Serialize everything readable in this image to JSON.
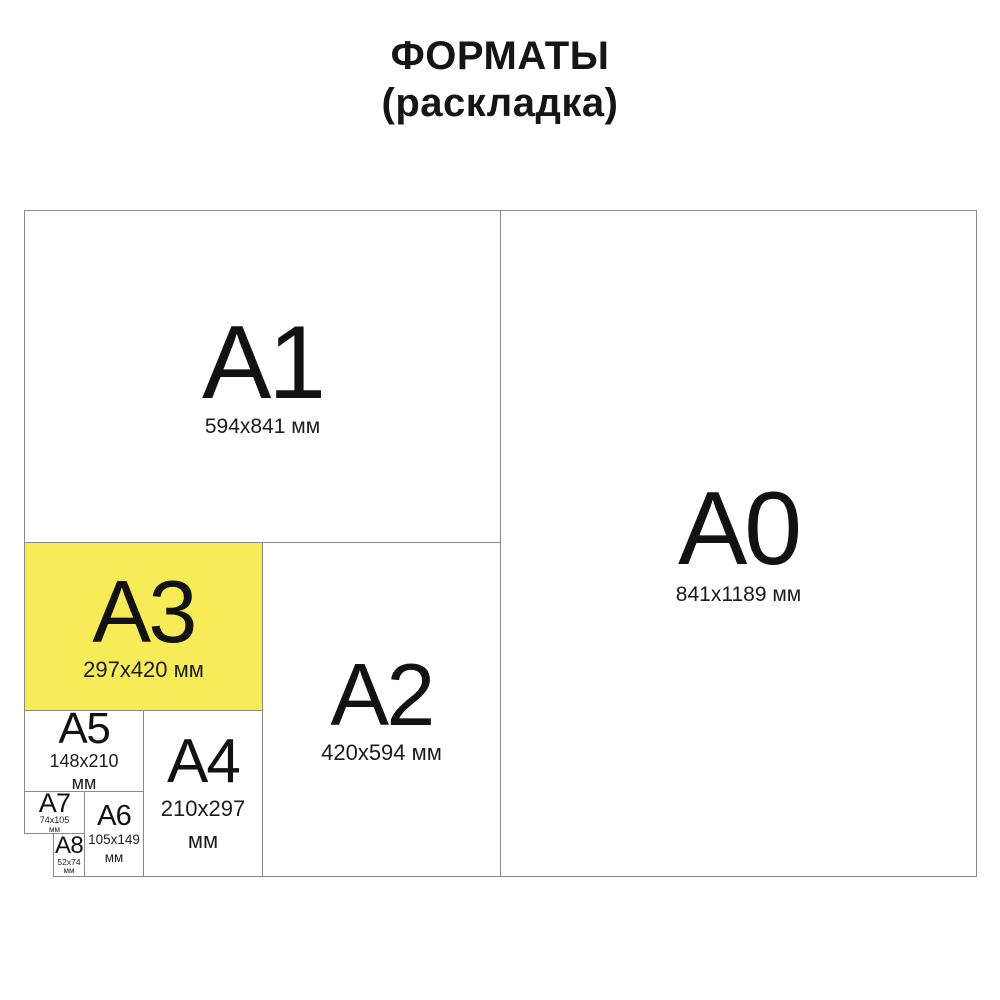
{
  "title": {
    "line1": "ФОРМАТЫ",
    "line2": "(раскладка)"
  },
  "colors": {
    "highlight_fill": "#F7EC58",
    "sheet_border": "#8a8a8a",
    "background": "#ffffff",
    "text": "#111111"
  },
  "formats": [
    {
      "id": "A1",
      "label": "A1",
      "dimensions": "594x841 мм",
      "highlighted": false
    },
    {
      "id": "A0",
      "label": "A0",
      "dimensions": "841x1189 мм",
      "highlighted": false
    },
    {
      "id": "A3",
      "label": "A3",
      "dimensions": "297x420 мм",
      "highlighted": true
    },
    {
      "id": "A2",
      "label": "A2",
      "dimensions": "420x594 мм",
      "highlighted": false
    },
    {
      "id": "A5",
      "label": "A5",
      "dimensions": "148x210",
      "unit": "мм",
      "highlighted": false
    },
    {
      "id": "A4",
      "label": "A4",
      "dimensions": "210x297",
      "unit": "мм",
      "highlighted": false
    },
    {
      "id": "A7",
      "label": "A7",
      "dimensions": "74x105",
      "unit": "мм",
      "highlighted": false
    },
    {
      "id": "A6",
      "label": "A6",
      "dimensions": "105x149",
      "unit": "мм",
      "highlighted": false
    },
    {
      "id": "A8",
      "label": "A8",
      "dimensions": "52x74",
      "unit": "мм",
      "highlighted": false
    }
  ]
}
